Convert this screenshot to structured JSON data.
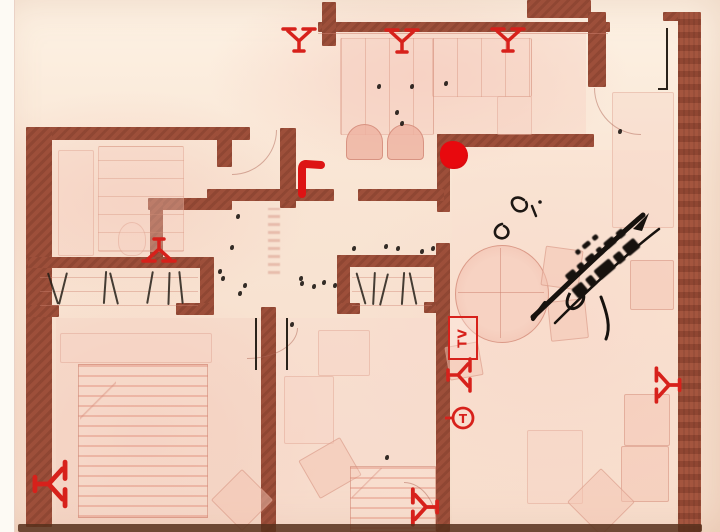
{
  "document": {
    "kind": "scanned apartment floor plan",
    "style": "red-line blueprint on pink paper with ink stamp and annotations"
  },
  "annotations": {
    "tv_label": "TV",
    "thermostat_label": "T"
  },
  "palette": {
    "paper": "#f8e5d5",
    "paper_highlight": "#fdf3e6",
    "paper_pink": "#f3c9ba",
    "wall": "#9d4f3a",
    "wall_dark": "#7c3a2a",
    "furniture_fill": "#f3c3b2",
    "furniture_line": "#d89480",
    "annotation_red": "#d7211b",
    "ink_black": "#1d1713",
    "page_margin": "#fdfaf4",
    "bottom_edge": "#57301c"
  },
  "icons": {
    "radiator-icon": "red Y-shaped wall mark",
    "tv-outlet-icon": "red rectangle labeled TV",
    "antenna-outlet-icon": "red branching Y mark on wall",
    "thermostat-icon": "red circle with T and wall stem",
    "door-swing-line": "thin black vertical ink line",
    "wardrobe-hatch": "black diagonal pen strokes",
    "ink-stamp": "black rotated rubber stamp with signature strokes",
    "ink-speck": "small black scan speck"
  },
  "artifacts": {
    "ink_specks": [
      [
        236,
        214
      ],
      [
        230,
        245
      ],
      [
        221,
        276
      ],
      [
        238,
        291
      ],
      [
        300,
        281
      ],
      [
        312,
        284
      ],
      [
        322,
        280
      ],
      [
        333,
        283
      ],
      [
        352,
        246
      ],
      [
        384,
        244
      ],
      [
        396,
        246
      ],
      [
        420,
        249
      ],
      [
        431,
        246
      ],
      [
        377,
        84
      ],
      [
        410,
        84
      ],
      [
        395,
        110
      ],
      [
        400,
        121
      ],
      [
        444,
        81
      ],
      [
        618,
        129
      ],
      [
        218,
        269
      ],
      [
        243,
        283
      ],
      [
        299,
        276
      ],
      [
        385,
        455
      ],
      [
        290,
        322
      ]
    ],
    "wardrobe_hatches": [
      {
        "x": 52,
        "y": 272,
        "rot": -18
      },
      {
        "x": 62,
        "y": 272,
        "rot": 14
      },
      {
        "x": 104,
        "y": 271,
        "rot": 4
      },
      {
        "x": 113,
        "y": 272,
        "rot": -14
      },
      {
        "x": 149,
        "y": 271,
        "rot": 10
      },
      {
        "x": 168,
        "y": 272,
        "rot": 2
      },
      {
        "x": 180,
        "y": 271,
        "rot": -6
      },
      {
        "x": 360,
        "y": 272,
        "rot": -16
      },
      {
        "x": 373,
        "y": 272,
        "rot": 3
      },
      {
        "x": 383,
        "y": 273,
        "rot": 14
      },
      {
        "x": 402,
        "y": 272,
        "rot": 4
      },
      {
        "x": 412,
        "y": 272,
        "rot": -12
      }
    ]
  }
}
